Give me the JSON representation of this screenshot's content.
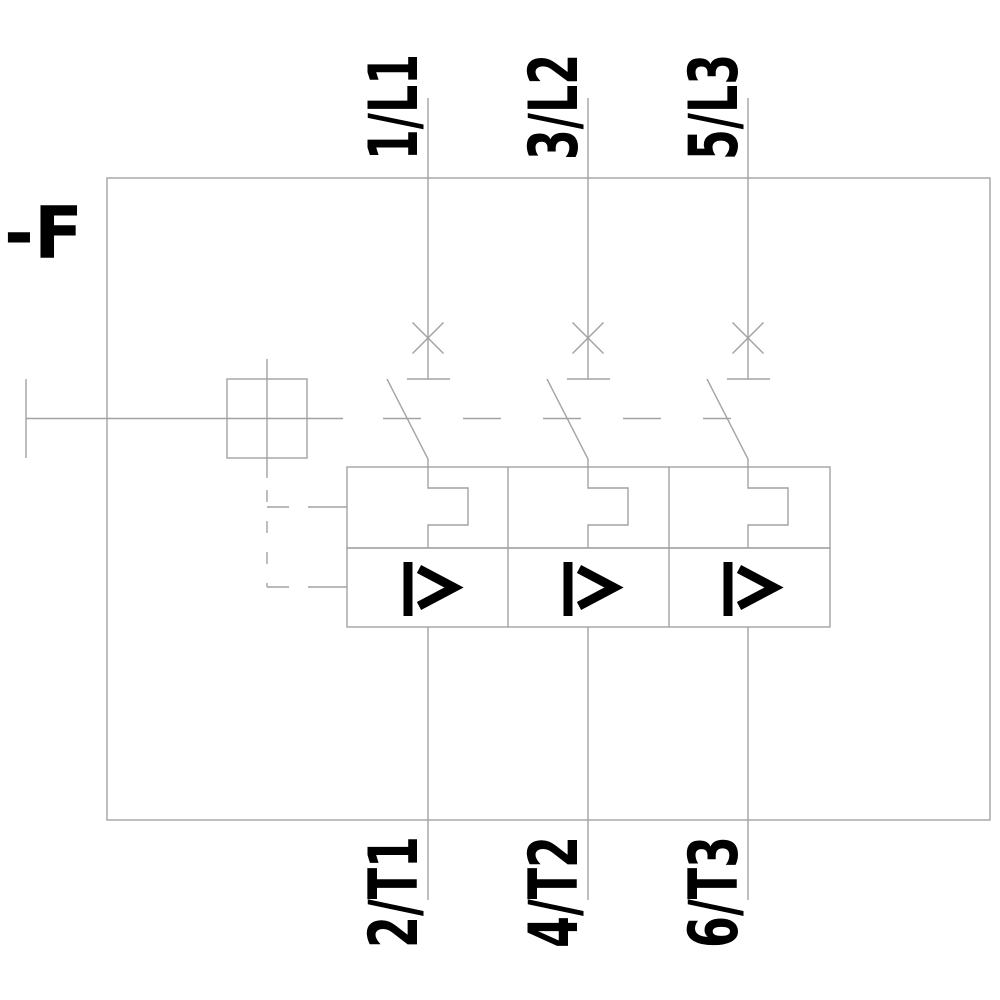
{
  "diagram": {
    "device_designator": "-F",
    "poles": [
      {
        "top_terminal": "1/L1",
        "bottom_terminal": "2/T1"
      },
      {
        "top_terminal": "3/L2",
        "bottom_terminal": "4/T2"
      },
      {
        "top_terminal": "5/L3",
        "bottom_terminal": "6/T3"
      }
    ],
    "symbols": {
      "circuit_breaker_contact": "X",
      "instantaneous_overcurrent_trip": "I>",
      "thermal_overload_trip": "notched-loop",
      "mechanical_linkage": "dashed-line",
      "manual_operator": "square-box"
    },
    "colors": {
      "line": "#a2a2a2",
      "text": "#000000",
      "background": "#ffffff"
    }
  }
}
